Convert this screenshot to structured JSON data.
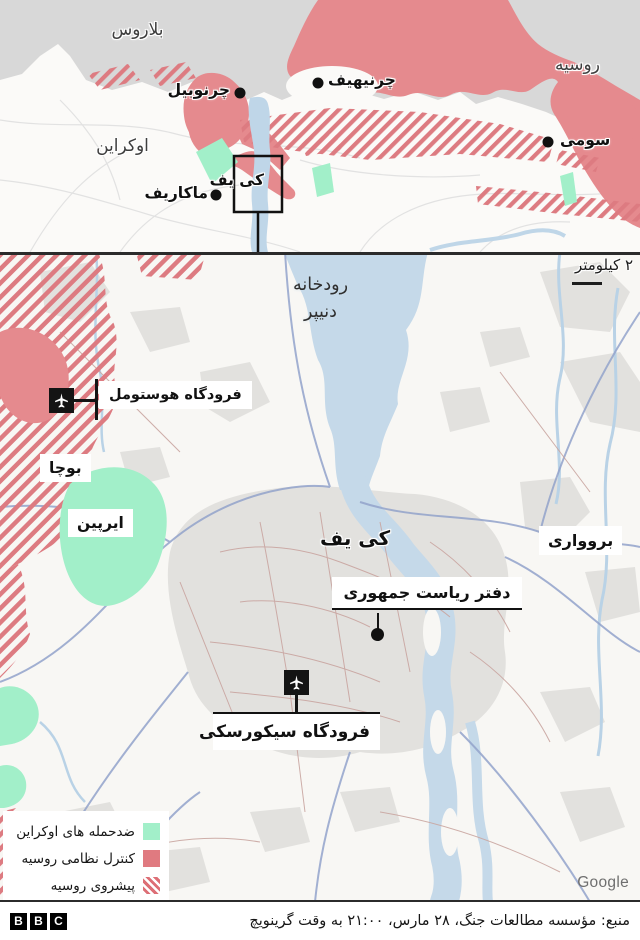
{
  "colors": {
    "russian_control": "#e58a8e",
    "russian_advance_stripe": "#dd7b81",
    "ukrainian_counterattack": "#a2efc9",
    "water": "#c5d9e9",
    "neighbor_gray": "#d8d8d8"
  },
  "overview": {
    "labels": {
      "belarus": "بلاروس",
      "russia": "روسیه",
      "ukraine": "اوکراین",
      "chernobyl": "چرنوبیل",
      "chernihiv": "چرنیهیف",
      "sumy": "سومی",
      "makariv": "ماکاریف",
      "kyiv_box": "کی یف"
    }
  },
  "detail": {
    "scale_label": "۲ کیلومتر",
    "river_line1": "رودخانه",
    "river_line2": "دنیپر",
    "hostomel_airport": "فرودگاه هوستومل",
    "bucha": "بوچا",
    "irpin": "ایرپین",
    "kyiv": "کی یف",
    "brovary": "بروواری",
    "presidential_office": "دفتر ریاست جمهوری",
    "sikorsky_airport": "فرودگاه سیکورسکی",
    "google_credit": "Google"
  },
  "legend": {
    "items": [
      {
        "label": "ضدحمله های اوکراین",
        "type": "green"
      },
      {
        "label": "کنترل نظامی روسیه",
        "type": "red"
      },
      {
        "label": "پیشروی روسیه",
        "type": "hatch"
      }
    ]
  },
  "footer": {
    "logo_letters": [
      "B",
      "B",
      "C"
    ],
    "source": "منبع: مؤسسه مطالعات جنگ، ۲۸ مارس، ۲۱:۰۰ به وقت گرینویچ"
  }
}
